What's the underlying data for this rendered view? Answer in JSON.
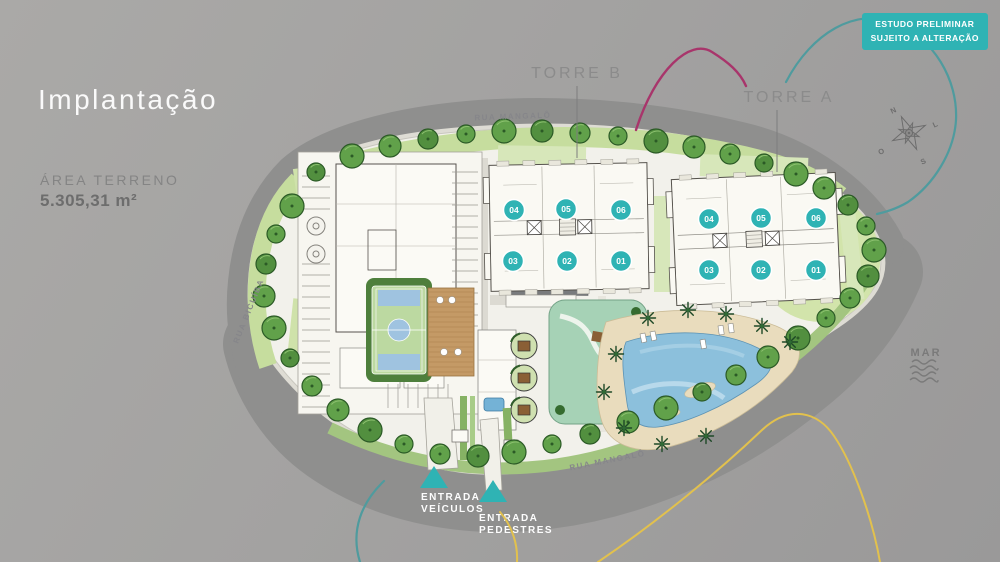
{
  "page": {
    "title": "Implantação"
  },
  "area": {
    "label": "ÁREA TERRENO",
    "value": "5.305,31 m²"
  },
  "badge": {
    "line1": "ESTUDO PRELIMINAR",
    "line2": "SUJEITO A ALTERAÇÃO"
  },
  "towers": {
    "b": {
      "label": "TORRE B",
      "units": [
        "04",
        "05",
        "06",
        "03",
        "02",
        "01"
      ]
    },
    "a": {
      "label": "TORRE A",
      "units": [
        "04",
        "05",
        "06",
        "03",
        "02",
        "01"
      ]
    }
  },
  "streets": {
    "top": "RUA MANGALÔ",
    "left": "RUA BICUÍBA",
    "bottom": "RUA MANGALÔ"
  },
  "entrances": {
    "vehicles": {
      "line1": "ENTRADA",
      "line2": "VEÍCULOS"
    },
    "pedestrians": {
      "line1": "ENTRADA",
      "line2": "PEDESTRES"
    }
  },
  "compass": {
    "n": "N",
    "l": "L",
    "o": "O",
    "s": "S"
  },
  "sea": {
    "label": "MAR"
  },
  "colors": {
    "teal": "#2fb3b4",
    "magenta": "#a8356b",
    "yellow": "#e2c14d",
    "teal_curve": "#4f9b9e"
  }
}
